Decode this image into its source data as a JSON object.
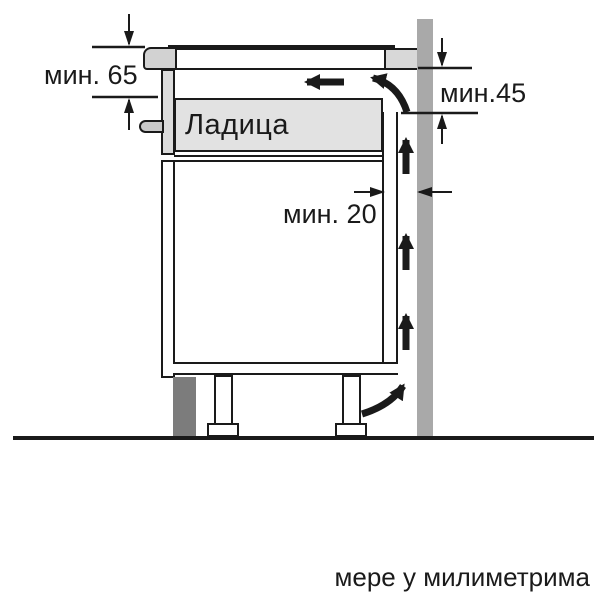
{
  "annotations": {
    "min65": "мин. 65",
    "min45": "мин.45",
    "min20": "мин. 20"
  },
  "cabinet": {
    "drawer_label": "Ладица"
  },
  "caption": "мере у милиметрима",
  "colors": {
    "line": "#1a1a1a",
    "wall": "#a9a9a9",
    "plinth": "#7c7c7c",
    "drawer_fill": "#e2e2e2",
    "hob_trim": "#d2d2d2",
    "worktop_end": "#d8d8d8",
    "front_panel_upper": "#dcdcdc",
    "handle": "#c9c9c9"
  }
}
